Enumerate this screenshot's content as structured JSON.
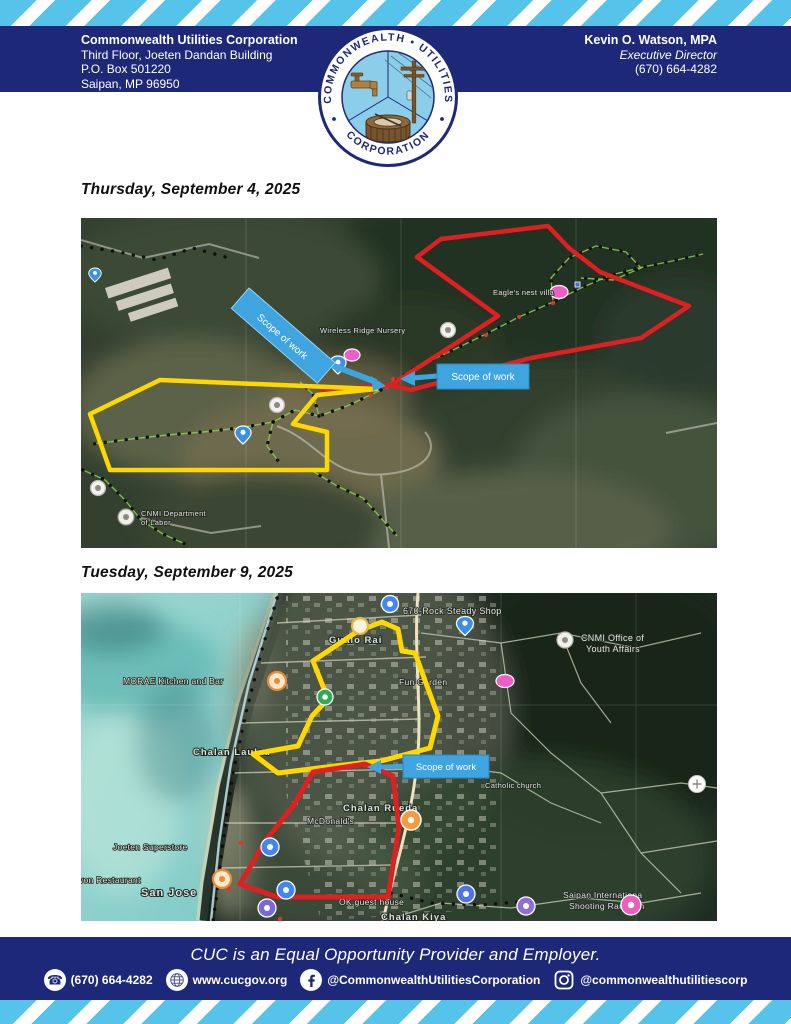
{
  "header": {
    "org_name": "Commonwealth Utilities Corporation",
    "address_lines": [
      "Third Floor, Joeten Dandan Building",
      "P.O. Box 501220",
      "Saipan, MP 96950"
    ],
    "officer_name": "Kevin O. Watson, MPA",
    "officer_title": "Executive Director",
    "officer_phone": "(670) 664-4282",
    "logo": {
      "arc_top": "COMMONWEALTH • UTILITIES",
      "arc_bottom": "CORPORATION"
    }
  },
  "sections": [
    {
      "date_heading": "Thursday, September 4, 2025"
    },
    {
      "date_heading": "Tuesday, September 9, 2025"
    }
  ],
  "map1": {
    "scope_labels": [
      "Scope of work",
      "Scope of work"
    ],
    "labels": [
      {
        "text": "Eagle's nest villa"
      },
      {
        "text": "Wireless Ridge Nursery"
      },
      {
        "text": "CNMI Department"
      },
      {
        "text": "of Labor"
      }
    ],
    "outline_colors": {
      "red": "#e02020",
      "yellow": "#ffd800"
    }
  },
  "map2": {
    "scope_label": "Scope of work",
    "labels": [
      {
        "text": "670-Rock Steady Shop"
      },
      {
        "text": "Gualo Rai"
      },
      {
        "text": "CNMI Office of"
      },
      {
        "text": "Youth Affairs"
      },
      {
        "text": "MORAE Kitchen and Bar"
      },
      {
        "text": "Fun Garden"
      },
      {
        "text": "Chalan Laulau"
      },
      {
        "text": "Catholic church"
      },
      {
        "text": "Chalan Rueda"
      },
      {
        "text": "McDonald's"
      },
      {
        "text": "Joeten Superstore"
      },
      {
        "text": "won Restaurant"
      },
      {
        "text": "San Jose"
      },
      {
        "text": "OK guest house"
      },
      {
        "text": "Saipan Internationa"
      },
      {
        "text": "Shooting Range In"
      },
      {
        "text": "Chalan Kiya"
      }
    ],
    "outline_colors": {
      "red": "#e02020",
      "yellow": "#ffd800"
    }
  },
  "footer": {
    "tagline": "CUC is an Equal Opportunity Provider and Employer.",
    "contacts": [
      {
        "icon": "phone-icon",
        "text": "(670) 664-4282"
      },
      {
        "icon": "globe-icon",
        "text": "www.cucgov.org"
      },
      {
        "icon": "facebook-icon",
        "text": "@CommonwealthUtilitiesCorporation"
      },
      {
        "icon": "instagram-icon",
        "text": "@commonwealthutilitiescorp"
      }
    ]
  },
  "colors": {
    "navy": "#1e2878",
    "stripe_blue": "#55c3ea",
    "scope_blue": "#3fa5e0"
  }
}
